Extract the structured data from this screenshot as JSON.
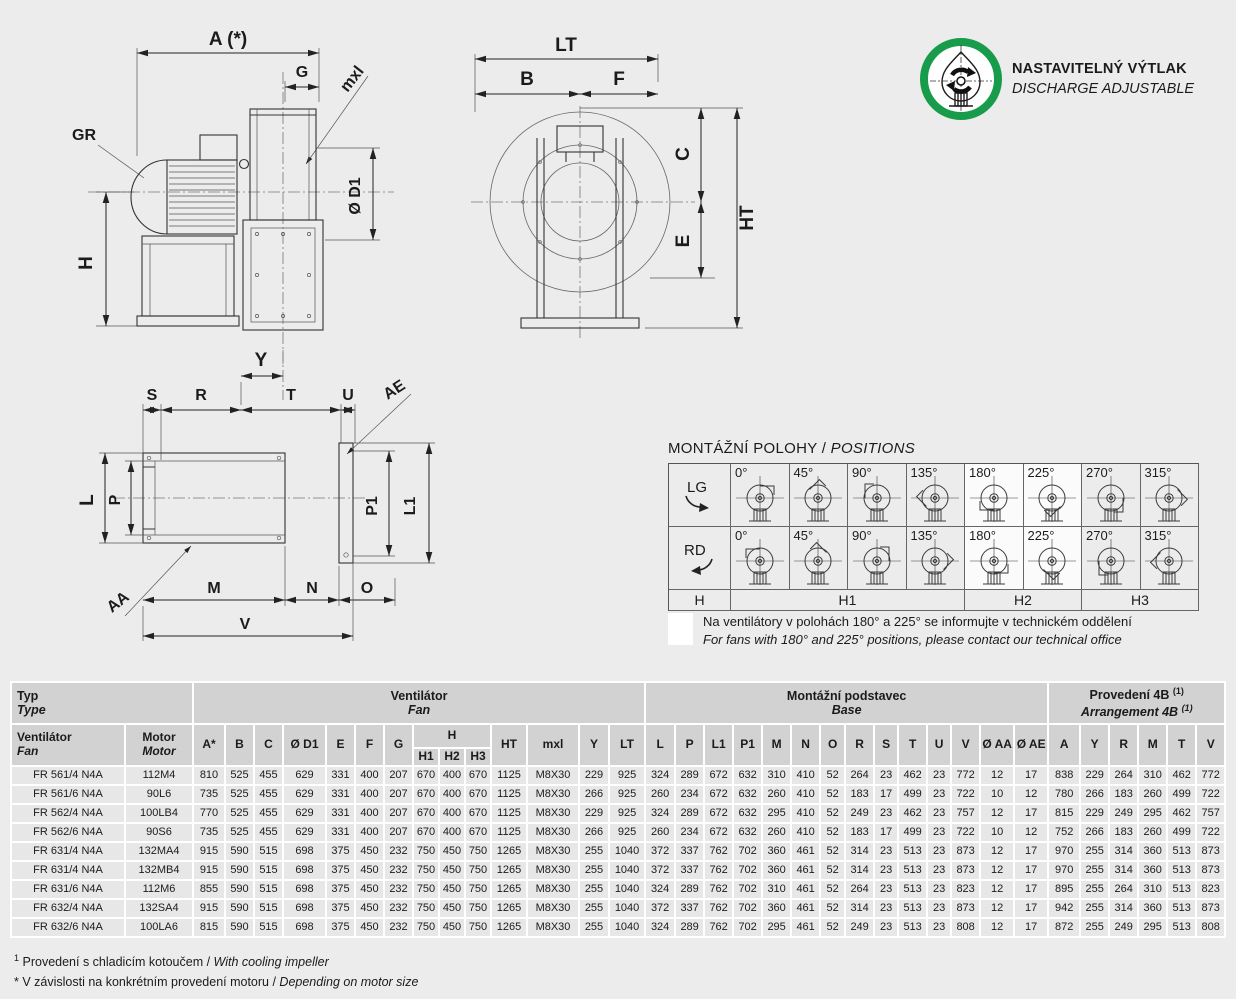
{
  "badge": {
    "line1": "NASTAVITELNÝ VÝTLAK",
    "line2": "DISCHARGE ADJUSTABLE",
    "ring_color": "#189c4c"
  },
  "drawings": {
    "side": {
      "a": "A (*)",
      "g": "G",
      "mxl": "mxl",
      "gr": "GR",
      "d1": "Ø D1",
      "h": "H"
    },
    "front": {
      "lt": "LT",
      "b": "B",
      "f": "F",
      "c": "C",
      "e": "E",
      "ht": "HT"
    },
    "base": {
      "y": "Y",
      "s": "S",
      "r": "R",
      "t": "T",
      "u": "U",
      "ae": "AE",
      "l": "L",
      "p": "P",
      "p1": "P1",
      "l1": "L1",
      "aa": "AA",
      "m": "M",
      "n": "N",
      "o": "O",
      "v": "V"
    }
  },
  "positions": {
    "title_cs": "MONTÁŽNÍ POLOHY",
    "title_sep": " / ",
    "title_en": "POSITIONS",
    "row_labels": [
      "LG",
      "RD"
    ],
    "angles": [
      "0°",
      "45°",
      "90°",
      "135°",
      "180°",
      "225°",
      "270°",
      "315°"
    ],
    "highlighted": [
      "180°",
      "225°"
    ],
    "footer_cells": [
      {
        "label": "H",
        "span": 1
      },
      {
        "label": "H1",
        "span": 4
      },
      {
        "label": "H2",
        "span": 2
      },
      {
        "label": "H3",
        "span": 2
      }
    ],
    "note_cs": "Na ventilátory v polohách 180° a 225° se informujte v technickém oddělení",
    "note_en": "For fans with 180° and 225° positions, please contact our technical office"
  },
  "table": {
    "groups": [
      {
        "cs": "Typ",
        "en": "Type",
        "span": 2
      },
      {
        "cs": "Ventilátor",
        "en": "Fan",
        "span": 14
      },
      {
        "cs": "Montážní podstavec",
        "en": "Base",
        "span": 14
      },
      {
        "cs": "Provedení 4B",
        "en": "Arrangement 4B",
        "sup": "(1)",
        "span": 6
      }
    ],
    "first_col": {
      "cs": "Ventilátor",
      "en": "Fan"
    },
    "second_col": {
      "cs": "Motor",
      "en": "Motor"
    },
    "cols_before_h": [
      "A*",
      "B",
      "C",
      "Ø D1",
      "E",
      "F",
      "G"
    ],
    "h_label": "H",
    "h_sub": [
      "H1",
      "H2",
      "H3"
    ],
    "cols_after_h": [
      "HT",
      "mxl",
      "Y",
      "LT",
      "L",
      "P",
      "L1",
      "P1",
      "M",
      "N",
      "O",
      "R",
      "S",
      "T",
      "U",
      "V",
      "Ø AA",
      "Ø AE",
      "A",
      "Y",
      "R",
      "M",
      "T",
      "V"
    ],
    "rows": [
      [
        "FR 561/4 N4A",
        "112M4",
        "810",
        "525",
        "455",
        "629",
        "331",
        "400",
        "207",
        "670",
        "400",
        "670",
        "1125",
        "M8X30",
        "229",
        "925",
        "324",
        "289",
        "672",
        "632",
        "310",
        "410",
        "52",
        "264",
        "23",
        "462",
        "23",
        "772",
        "12",
        "17",
        "838",
        "229",
        "264",
        "310",
        "462",
        "772"
      ],
      [
        "FR 561/6 N4A",
        "90L6",
        "735",
        "525",
        "455",
        "629",
        "331",
        "400",
        "207",
        "670",
        "400",
        "670",
        "1125",
        "M8X30",
        "266",
        "925",
        "260",
        "234",
        "672",
        "632",
        "260",
        "410",
        "52",
        "183",
        "17",
        "499",
        "23",
        "722",
        "10",
        "12",
        "780",
        "266",
        "183",
        "260",
        "499",
        "722"
      ],
      [
        "FR 562/4 N4A",
        "100LB4",
        "770",
        "525",
        "455",
        "629",
        "331",
        "400",
        "207",
        "670",
        "400",
        "670",
        "1125",
        "M8X30",
        "229",
        "925",
        "324",
        "289",
        "672",
        "632",
        "295",
        "410",
        "52",
        "249",
        "23",
        "462",
        "23",
        "757",
        "12",
        "17",
        "815",
        "229",
        "249",
        "295",
        "462",
        "757"
      ],
      [
        "FR 562/6 N4A",
        "90S6",
        "735",
        "525",
        "455",
        "629",
        "331",
        "400",
        "207",
        "670",
        "400",
        "670",
        "1125",
        "M8X30",
        "266",
        "925",
        "260",
        "234",
        "672",
        "632",
        "260",
        "410",
        "52",
        "183",
        "17",
        "499",
        "23",
        "722",
        "10",
        "12",
        "752",
        "266",
        "183",
        "260",
        "499",
        "722"
      ],
      [
        "FR 631/4 N4A",
        "132MA4",
        "915",
        "590",
        "515",
        "698",
        "375",
        "450",
        "232",
        "750",
        "450",
        "750",
        "1265",
        "M8X30",
        "255",
        "1040",
        "372",
        "337",
        "762",
        "702",
        "360",
        "461",
        "52",
        "314",
        "23",
        "513",
        "23",
        "873",
        "12",
        "17",
        "970",
        "255",
        "314",
        "360",
        "513",
        "873"
      ],
      [
        "FR 631/4 N4A",
        "132MB4",
        "915",
        "590",
        "515",
        "698",
        "375",
        "450",
        "232",
        "750",
        "450",
        "750",
        "1265",
        "M8X30",
        "255",
        "1040",
        "372",
        "337",
        "762",
        "702",
        "360",
        "461",
        "52",
        "314",
        "23",
        "513",
        "23",
        "873",
        "12",
        "17",
        "970",
        "255",
        "314",
        "360",
        "513",
        "873"
      ],
      [
        "FR 631/6 N4A",
        "112M6",
        "855",
        "590",
        "515",
        "698",
        "375",
        "450",
        "232",
        "750",
        "450",
        "750",
        "1265",
        "M8X30",
        "255",
        "1040",
        "324",
        "289",
        "762",
        "702",
        "310",
        "461",
        "52",
        "264",
        "23",
        "513",
        "23",
        "823",
        "12",
        "17",
        "895",
        "255",
        "264",
        "310",
        "513",
        "823"
      ],
      [
        "FR 632/4 N4A",
        "132SA4",
        "915",
        "590",
        "515",
        "698",
        "375",
        "450",
        "232",
        "750",
        "450",
        "750",
        "1265",
        "M8X30",
        "255",
        "1040",
        "372",
        "337",
        "762",
        "702",
        "360",
        "461",
        "52",
        "314",
        "23",
        "513",
        "23",
        "873",
        "12",
        "17",
        "942",
        "255",
        "314",
        "360",
        "513",
        "873"
      ],
      [
        "FR 632/6 N4A",
        "100LA6",
        "815",
        "590",
        "515",
        "698",
        "375",
        "450",
        "232",
        "750",
        "450",
        "750",
        "1265",
        "M8X30",
        "255",
        "1040",
        "324",
        "289",
        "762",
        "702",
        "295",
        "461",
        "52",
        "249",
        "23",
        "513",
        "23",
        "808",
        "12",
        "17",
        "872",
        "255",
        "249",
        "295",
        "513",
        "808"
      ]
    ]
  },
  "footnotes": [
    {
      "marker": "1",
      "sup": true,
      "cs": "Provedení s chladicím kotoučem",
      "sep": " / ",
      "en": "With cooling impeller"
    },
    {
      "marker": "*",
      "sup": false,
      "cs": "V závislosti na konkrétním provedení motoru",
      "sep": " / ",
      "en": "Depending on motor size"
    }
  ]
}
